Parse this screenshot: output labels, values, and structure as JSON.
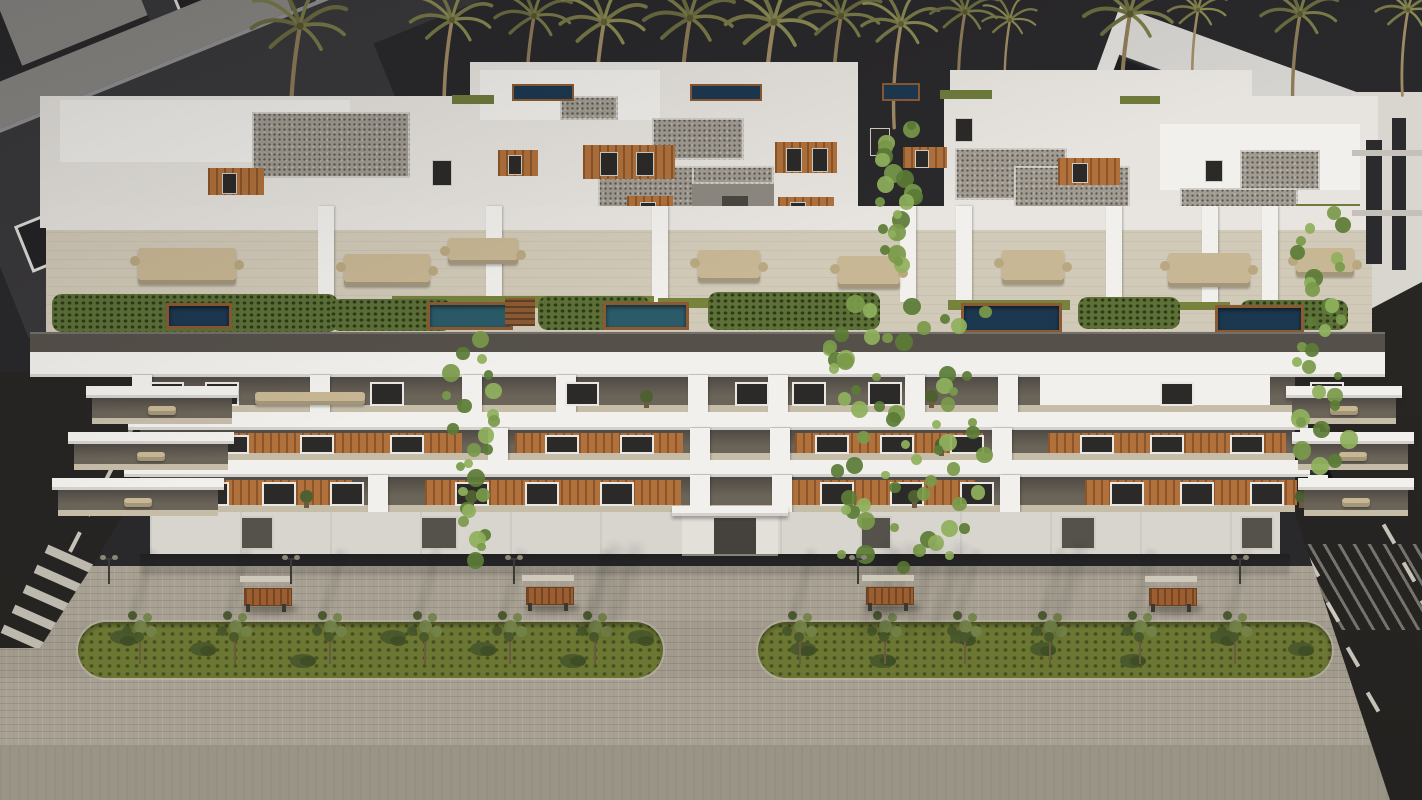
{
  "meta": {
    "width": 1422,
    "height": 800,
    "subject": "Aerial dusk 3D architectural rendering of a modern white apartment complex with rooftop pools, wood-slat facades, palm trees and a landscaped pedestrian promenade"
  },
  "palette": {
    "sky": "#29282a",
    "frond": "#6b6b40",
    "frond2": "#7a7a49",
    "trunkc": "#8d7b58",
    "ndark": "#39383a",
    "nframe": "#dddcd8",
    "nroof": "#8a8884",
    "nglass": "#202224",
    "white": "#e7e4df",
    "white2": "#f2f0ec",
    "dim": "#cbc7c0",
    "gravel": "#a19b91",
    "gravdot": "#5c5851",
    "wood": "#b0713c",
    "terr": "#d2cab8",
    "hedge": "#5c7037",
    "lawn": "#77823d",
    "poolteal": "#2b5a68",
    "poolnavy": "#1c3850",
    "deck": "#8a5a32",
    "parapet": "#55504a",
    "recess": "#6b6459",
    "recessdk": "#4f4a44",
    "rfloor": "#c6bda9",
    "win": "#2c2a28",
    "wframe": "#e9e7e3",
    "ground": "#d8d5cf",
    "pav": "#a8a193",
    "pav2": "#a29b8d",
    "apron": "#9a9487",
    "grass": "#6c7733",
    "bush": "#49592c",
    "tree": "#73834a",
    "road": "#2b2925",
    "rline": "#d8d4c8",
    "bench": "#9c5e30",
    "benchfr": "#cfc9bb",
    "lamp": "#3c3a35",
    "furn": "#c8b794",
    "vinea": "#7a9a4a",
    "vineb": "#5b7c36",
    "vinec": "#8fb05c",
    "carc": "#131316"
  },
  "palms": [
    [
      300,
      26,
      1.05
    ],
    [
      452,
      20,
      0.9
    ],
    [
      534,
      16,
      0.85
    ],
    [
      604,
      22,
      0.95
    ],
    [
      690,
      18,
      1.0
    ],
    [
      774,
      22,
      1.05
    ],
    [
      841,
      16,
      0.9
    ],
    [
      901,
      24,
      0.85
    ],
    [
      965,
      12,
      0.75
    ],
    [
      1010,
      20,
      0.6
    ],
    [
      1130,
      14,
      1.0
    ],
    [
      1198,
      10,
      0.65
    ],
    [
      1300,
      14,
      0.85
    ],
    [
      1408,
      10,
      0.7
    ]
  ],
  "neighbor_left": {
    "far": {
      "cols": 5,
      "rows": 2,
      "w": 26,
      "h": 34,
      "px": 66,
      "py": 64,
      "ox": 30,
      "oy": 50
    },
    "near": {
      "cols": 5,
      "rows": 2,
      "w": 32,
      "h": 44,
      "px": 76,
      "py": 86,
      "ox": 28,
      "oy": 96
    }
  },
  "neighbor_right": {
    "rows": 3
  },
  "tower_far_right": {
    "slots": [
      [
        1366,
        140,
        16,
        124
      ],
      [
        1392,
        118,
        14,
        152
      ]
    ],
    "ledges": [
      [
        1352,
        150,
        70,
        6
      ],
      [
        1352,
        210,
        70,
        6
      ]
    ]
  },
  "penthouse": {
    "blocks": [
      [
        40,
        96,
        818,
        132
      ],
      [
        944,
        96,
        434,
        132
      ],
      [
        470,
        62,
        388,
        170
      ],
      [
        950,
        70,
        302,
        120
      ]
    ],
    "highlights": [
      [
        60,
        100,
        290,
        62
      ],
      [
        1160,
        124,
        200,
        66
      ],
      [
        480,
        70,
        180,
        50
      ]
    ],
    "gravel": [
      [
        252,
        112,
        158,
        66
      ],
      [
        598,
        166,
        122,
        50
      ],
      [
        652,
        118,
        92,
        42
      ],
      [
        332,
        206,
        66,
        30
      ],
      [
        955,
        148,
        112,
        52
      ],
      [
        1014,
        166,
        116,
        46
      ],
      [
        1180,
        188,
        118,
        38
      ],
      [
        560,
        96,
        58,
        24
      ],
      [
        1240,
        150,
        80,
        40
      ]
    ],
    "wood": [
      [
        583,
        145,
        92,
        34
      ],
      [
        775,
        142,
        62,
        31
      ],
      [
        627,
        196,
        46,
        30
      ],
      [
        778,
        197,
        56,
        26
      ],
      [
        903,
        147,
        44,
        21
      ],
      [
        1058,
        158,
        62,
        27
      ],
      [
        208,
        168,
        56,
        27
      ],
      [
        498,
        150,
        40,
        26
      ]
    ],
    "windows": [
      [
        600,
        152,
        16,
        22
      ],
      [
        636,
        152,
        16,
        22
      ],
      [
        786,
        148,
        14,
        22
      ],
      [
        812,
        148,
        14,
        22
      ],
      [
        640,
        202,
        14,
        20
      ],
      [
        790,
        202,
        14,
        20
      ],
      [
        915,
        150,
        12,
        16
      ],
      [
        1072,
        163,
        14,
        18
      ],
      [
        222,
        173,
        13,
        19
      ],
      [
        508,
        155,
        12,
        18
      ],
      [
        870,
        128,
        18,
        26
      ],
      [
        955,
        118,
        16,
        22
      ],
      [
        432,
        160,
        18,
        24
      ],
      [
        1205,
        160,
        16,
        20
      ]
    ],
    "pools": [
      [
        512,
        84,
        58,
        13
      ],
      [
        690,
        84,
        68,
        13
      ],
      [
        882,
        83,
        34,
        14
      ]
    ],
    "roofs": [
      [
        452,
        95,
        42,
        9
      ],
      [
        940,
        90,
        52,
        9
      ],
      [
        1296,
        204,
        64,
        10
      ],
      [
        1120,
        96,
        40,
        8
      ]
    ],
    "tower": [
      692,
      166,
      82,
      64
    ]
  },
  "terrace": {
    "partitions": [
      318,
      486,
      652,
      900,
      956,
      1106,
      1202,
      1262
    ],
    "furniture": [
      [
        138,
        248,
        98,
        36
      ],
      [
        344,
        254,
        86,
        32
      ],
      [
        698,
        250,
        62,
        32
      ],
      [
        838,
        256,
        62,
        32
      ],
      [
        1002,
        250,
        62,
        34
      ],
      [
        1168,
        253,
        82,
        34
      ],
      [
        1296,
        248,
        58,
        28
      ],
      [
        448,
        238,
        70,
        26
      ]
    ],
    "hedges": [
      [
        52,
        294,
        286,
        38
      ],
      [
        330,
        299,
        122,
        32
      ],
      [
        538,
        296,
        112,
        34
      ],
      [
        708,
        292,
        172,
        38
      ],
      [
        1078,
        297,
        102,
        32
      ],
      [
        1240,
        300,
        108,
        30
      ]
    ],
    "lawns": [
      [
        392,
        296,
        262,
        12
      ],
      [
        658,
        298,
        202,
        10
      ],
      [
        948,
        300,
        122,
        10
      ],
      [
        1150,
        302,
        80,
        8
      ]
    ],
    "pools": [
      [
        427,
        302,
        80,
        22,
        "teal"
      ],
      [
        603,
        302,
        80,
        22,
        "teal"
      ],
      [
        961,
        303,
        95,
        24,
        "navy"
      ],
      [
        1215,
        305,
        83,
        22,
        "navy"
      ],
      [
        166,
        303,
        60,
        20,
        "navy"
      ]
    ],
    "deck": [
      505,
      298,
      30,
      28
    ]
  },
  "floors": [
    {
      "y": 377,
      "h": 35,
      "wood": [],
      "white_spans": [
        [
          1040,
          230
        ]
      ],
      "windows": [
        150,
        205,
        370,
        565,
        735,
        792,
        868,
        1160,
        1310
      ],
      "piers": [
        132,
        310,
        462,
        556,
        688,
        768,
        905,
        998
      ],
      "furniture": [
        [
          255,
          110
        ]
      ],
      "plants": [
        640,
        925
      ]
    },
    {
      "y": 430,
      "h": 30,
      "wood": [
        [
          150,
          312
        ],
        [
          515,
          168
        ],
        [
          795,
          188
        ],
        [
          1048,
          238
        ]
      ],
      "white_spans": [],
      "windows": [
        215,
        300,
        390,
        545,
        620,
        815,
        880,
        950,
        1080,
        1150,
        1230
      ],
      "piers": [
        488,
        690,
        770,
        992,
        1300
      ],
      "furniture": [],
      "plants": [
        935
      ]
    },
    {
      "y": 477,
      "h": 35,
      "wood": [
        [
          160,
          192
        ],
        [
          425,
          256
        ],
        [
          790,
          186
        ],
        [
          1085,
          212
        ]
      ],
      "white_spans": [],
      "windows": [
        195,
        262,
        330,
        455,
        525,
        600,
        820,
        890,
        960,
        1110,
        1180,
        1250
      ],
      "piers": [
        368,
        690,
        772,
        1000,
        1308
      ],
      "furniture": [],
      "plants": [
        300,
        465,
        908,
        1295
      ]
    }
  ],
  "ground": {
    "openings": [
      [
        240,
        30
      ],
      [
        420,
        34
      ],
      [
        860,
        28
      ],
      [
        1060,
        32
      ],
      [
        1240,
        30
      ]
    ],
    "door": [
      714,
      518,
      42,
      36
    ]
  },
  "side_balconies": [
    [
      86,
      386,
      152
    ],
    [
      68,
      432,
      166
    ],
    [
      52,
      478,
      172
    ],
    [
      1286,
      386,
      116
    ],
    [
      1292,
      432,
      122
    ],
    [
      1298,
      478,
      116
    ]
  ],
  "vines": [
    [
      878,
      118,
      42,
      150,
      22
    ],
    [
      445,
      335,
      55,
      225,
      26
    ],
    [
      825,
      292,
      165,
      270,
      62
    ],
    [
      1292,
      205,
      58,
      265,
      30
    ]
  ],
  "street": {
    "strips": [
      [
        78,
        622,
        585,
        56
      ],
      [
        758,
        622,
        574,
        56
      ]
    ],
    "trees": [
      140,
      235,
      330,
      425,
      510,
      595,
      800,
      885,
      965,
      1050,
      1140,
      1235
    ],
    "bushes": [
      110,
      190,
      290,
      380,
      470,
      560,
      628,
      790,
      870,
      950,
      1030,
      1120,
      1210,
      1288
    ],
    "benches": [
      [
        240,
        576
      ],
      [
        522,
        575
      ],
      [
        862,
        575
      ],
      [
        1145,
        576
      ]
    ],
    "lamps": [
      100,
      282,
      505,
      849,
      1231
    ],
    "big_shadows": [
      595,
      615,
      870,
      890,
      915,
      940,
      1060
    ],
    "left_dashes": [
      [
        118,
        432
      ],
      [
        100,
        468
      ],
      [
        82,
        504
      ],
      [
        64,
        540
      ]
    ],
    "right_dashes": [
      [
        1312,
        418
      ],
      [
        1334,
        456
      ],
      [
        1356,
        494
      ],
      [
        1378,
        532
      ],
      [
        1398,
        570
      ],
      [
        1416,
        608
      ],
      [
        1282,
        520
      ],
      [
        1302,
        565
      ],
      [
        1322,
        610
      ],
      [
        1342,
        655
      ],
      [
        1362,
        700
      ]
    ],
    "crosswalk": [
      [
        44,
        556
      ],
      [
        33,
        576
      ],
      [
        22,
        596
      ],
      [
        11,
        616
      ],
      [
        0,
        636
      ]
    ],
    "car": [
      1288,
      462
    ]
  }
}
